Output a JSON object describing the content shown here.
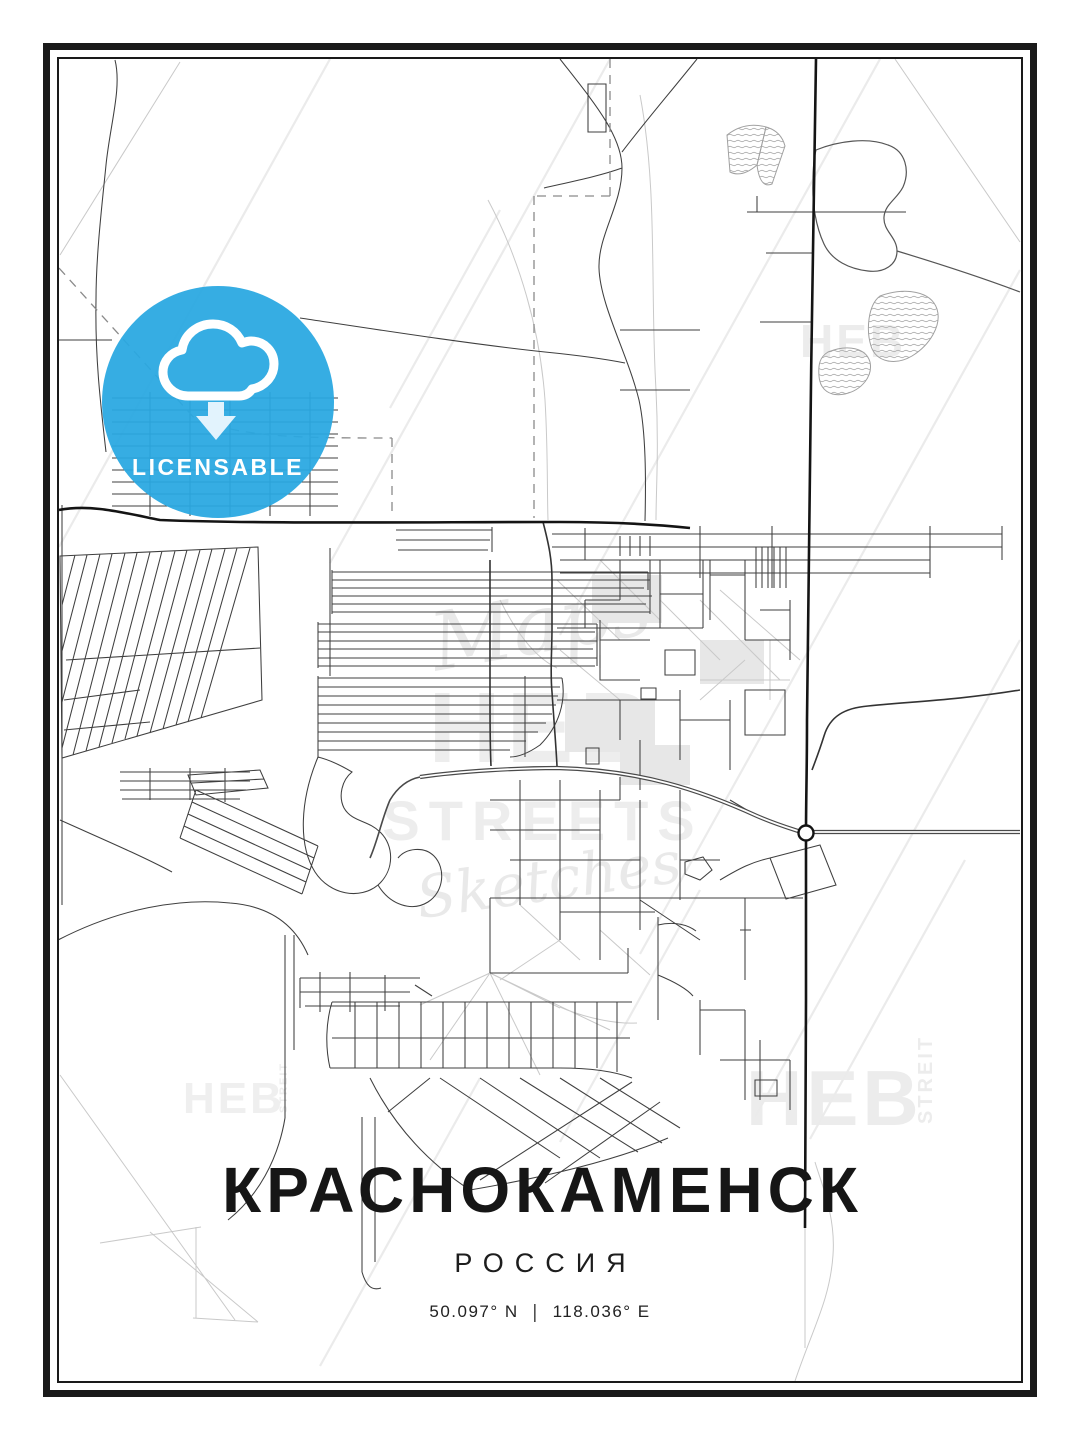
{
  "poster": {
    "title": "КРАСНОКАМЕНСК",
    "country": "РОССИЯ",
    "coordinates": {
      "lat": "50.097° N",
      "sep": "|",
      "lon": "118.036° E"
    }
  },
  "badge": {
    "label": "LICENSABLE",
    "color": "#29A8E1",
    "icon": "cloud-download-icon"
  },
  "watermarks": {
    "center": {
      "line1": "Maps",
      "line2": "HEB",
      "line3": "STREETS",
      "line4": "Sketches"
    },
    "corner_brand": "HEB",
    "corner_side": "STREIT"
  },
  "map": {
    "frame_color": "#1a1a1a",
    "road_dark": "#141414",
    "road_mid": "#3f3f3f",
    "road_light": "#c9c9c9",
    "water_outline": "#555555"
  }
}
